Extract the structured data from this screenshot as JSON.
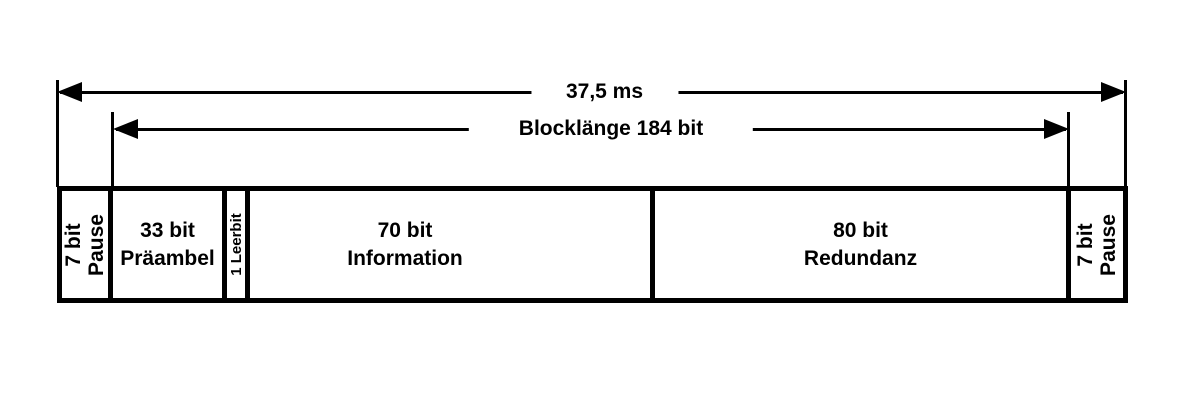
{
  "colors": {
    "ink": "#000000",
    "paper": "#ffffff"
  },
  "arrows": {
    "total": {
      "label": "37,5 ms"
    },
    "block": {
      "label": "Blocklänge 184 bit"
    }
  },
  "segments": {
    "pause_left": {
      "line1": "7 bit",
      "line2": "Pause"
    },
    "praeambel": {
      "line1": "33 bit",
      "line2": "Präambel"
    },
    "leerbit": {
      "line1": "1 Leerbit"
    },
    "information": {
      "line1": "70 bit",
      "line2": "Information"
    },
    "redundanz": {
      "line1": "80 bit",
      "line2": "Redundanz"
    },
    "pause_right": {
      "line1": "7 bit",
      "line2": "Pause"
    }
  }
}
